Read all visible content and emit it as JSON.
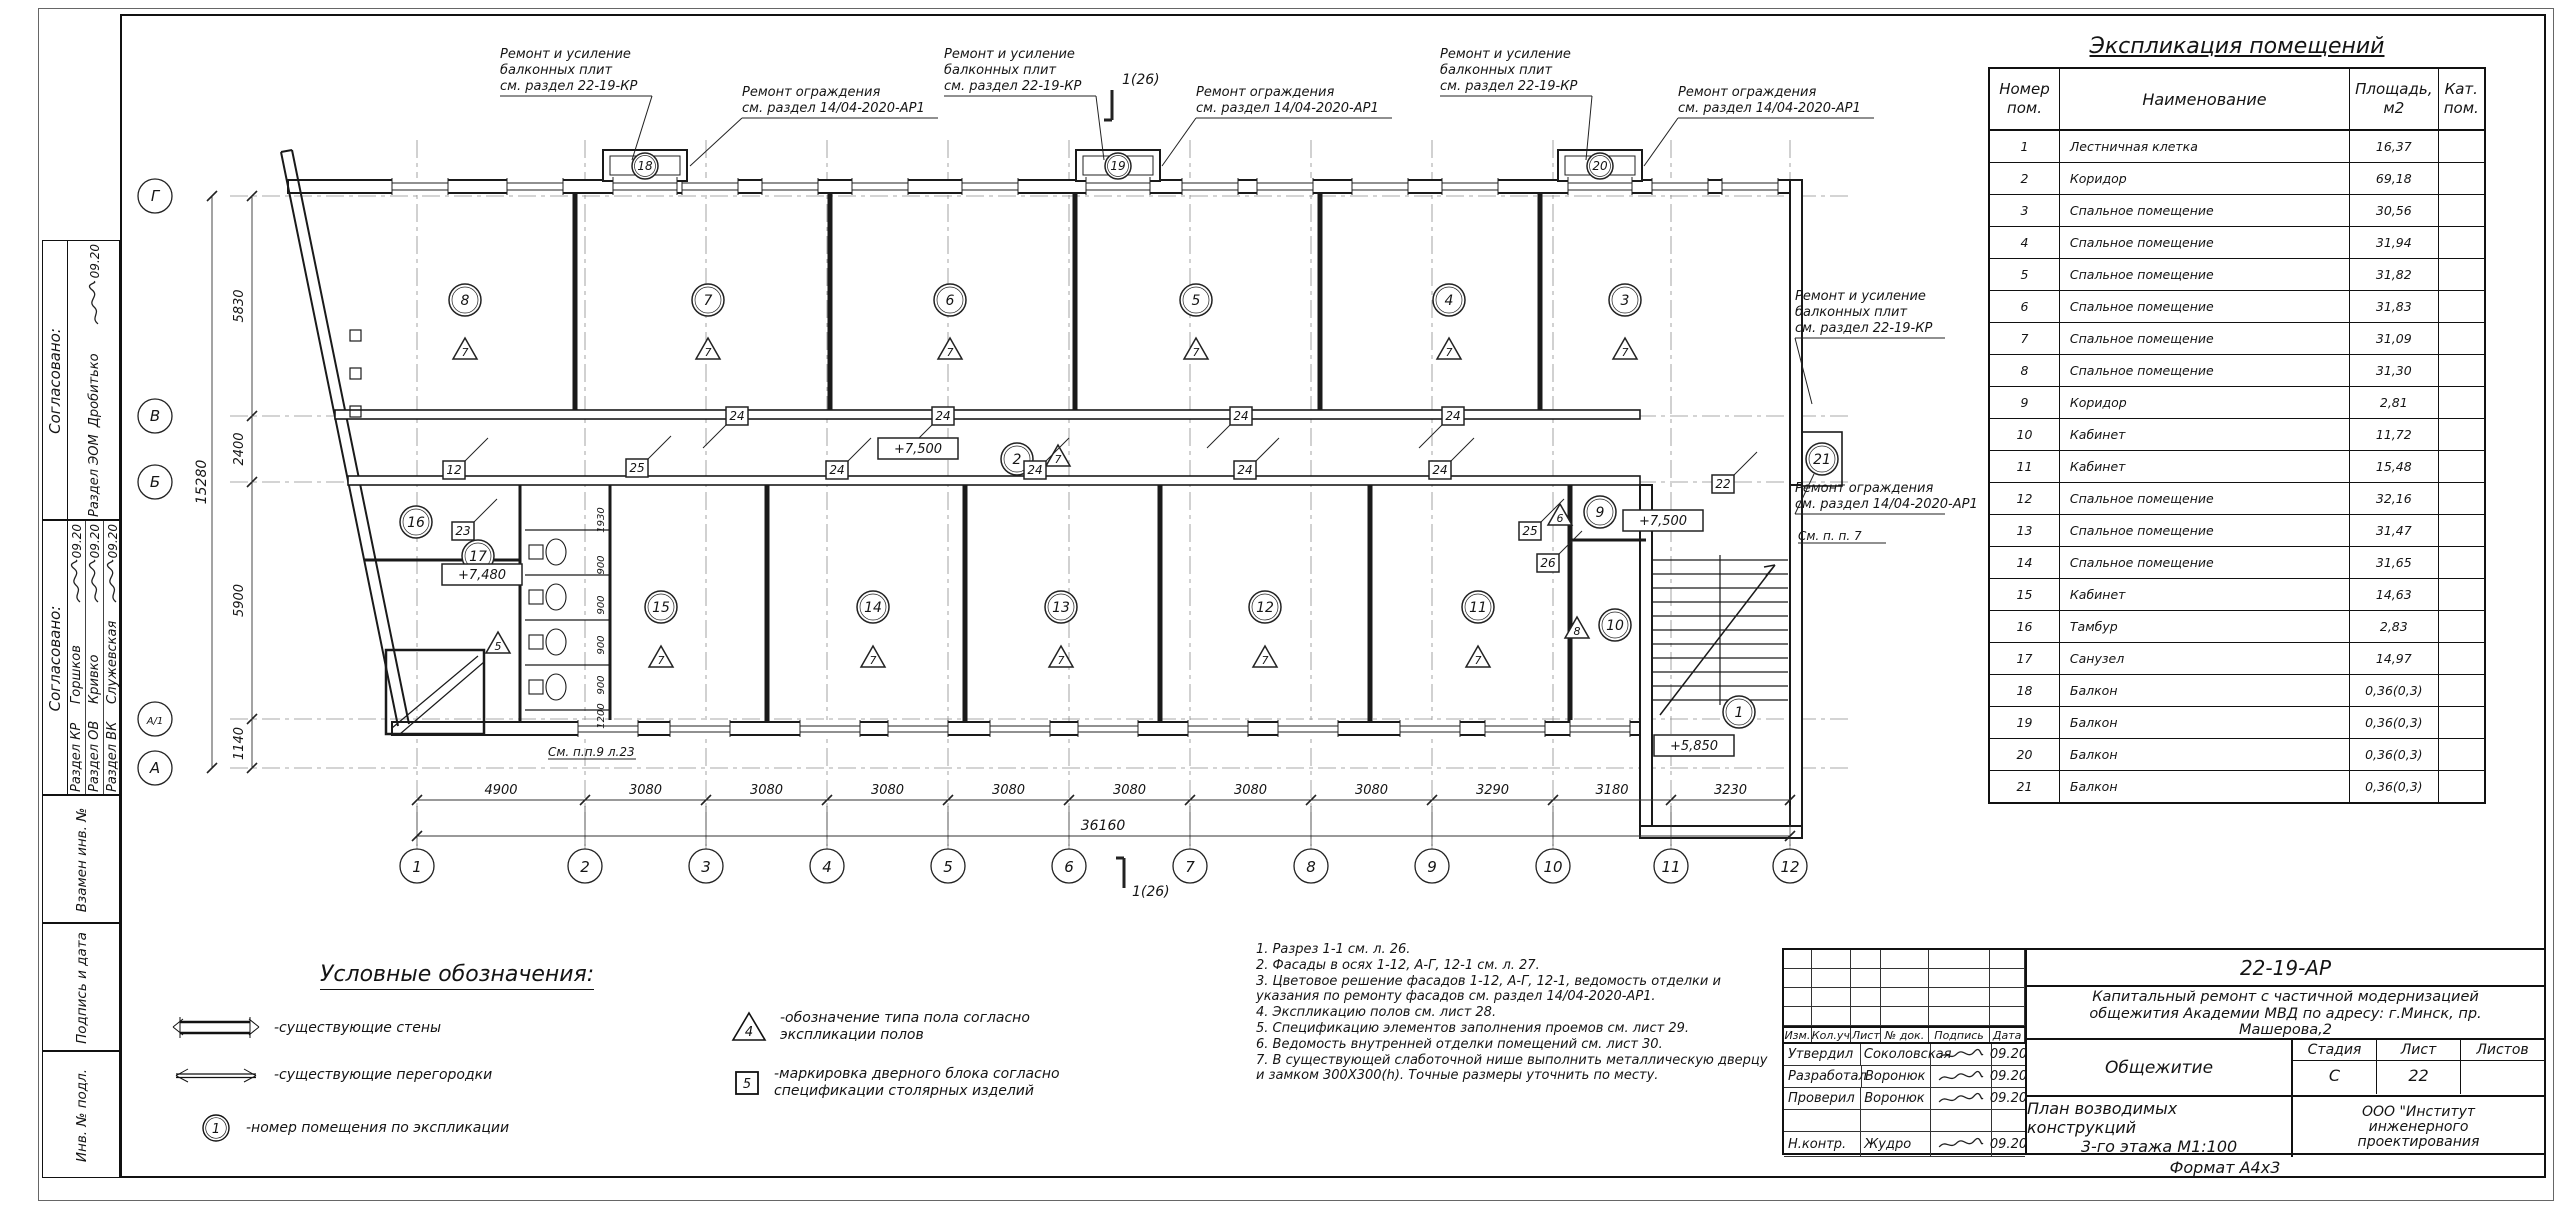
{
  "plan": {
    "axes_x": [
      {
        "l": "1",
        "x": 417
      },
      {
        "l": "2",
        "x": 585
      },
      {
        "l": "3",
        "x": 706
      },
      {
        "l": "4",
        "x": 827
      },
      {
        "l": "5",
        "x": 948
      },
      {
        "l": "6",
        "x": 1069
      },
      {
        "l": "7",
        "x": 1190
      },
      {
        "l": "8",
        "x": 1311
      },
      {
        "l": "9",
        "x": 1432
      },
      {
        "l": "10",
        "x": 1553
      },
      {
        "l": "11",
        "x": 1671
      },
      {
        "l": "12",
        "x": 1790
      }
    ],
    "dims_x": [
      "4900",
      "3080",
      "3080",
      "3080",
      "3080",
      "3080",
      "3080",
      "3080",
      "3290",
      "3180",
      "3230"
    ],
    "total_x": "36160",
    "axes_y": [
      {
        "l": "Г",
        "y": 196
      },
      {
        "l": "В",
        "y": 416
      },
      {
        "l": "Б",
        "y": 482
      },
      {
        "l": "А/1",
        "y": 719
      },
      {
        "l": "А",
        "y": 768
      }
    ],
    "dims_y": [
      "5830",
      "2400",
      "5900",
      "1140"
    ],
    "total_y": "15280",
    "section_mark": "1(26)",
    "rooms": [
      {
        "n": "8",
        "x": 465,
        "y": 300,
        "t": "7",
        "tx": 465,
        "ty": 352
      },
      {
        "n": "7",
        "x": 708,
        "y": 300,
        "t": "7",
        "tx": 708,
        "ty": 352
      },
      {
        "n": "6",
        "x": 950,
        "y": 300,
        "t": "7",
        "tx": 950,
        "ty": 352
      },
      {
        "n": "5",
        "x": 1196,
        "y": 300,
        "t": "7",
        "tx": 1196,
        "ty": 352
      },
      {
        "n": "4",
        "x": 1449,
        "y": 300,
        "t": "7",
        "tx": 1449,
        "ty": 352
      },
      {
        "n": "3",
        "x": 1625,
        "y": 300,
        "t": "7",
        "tx": 1625,
        "ty": 352
      },
      {
        "n": "2",
        "x": 1017,
        "y": 459,
        "t": "7",
        "tx": 1058,
        "ty": 459
      },
      {
        "n": "16",
        "x": 416,
        "y": 522
      },
      {
        "n": "17",
        "x": 478,
        "y": 556,
        "t": "5",
        "tx": 498,
        "ty": 646
      },
      {
        "n": "15",
        "x": 661,
        "y": 607,
        "t": "7",
        "tx": 661,
        "ty": 660
      },
      {
        "n": "14",
        "x": 873,
        "y": 607,
        "t": "7",
        "tx": 873,
        "ty": 660
      },
      {
        "n": "13",
        "x": 1061,
        "y": 607,
        "t": "7",
        "tx": 1061,
        "ty": 660
      },
      {
        "n": "12",
        "x": 1265,
        "y": 607,
        "t": "7",
        "tx": 1265,
        "ty": 660
      },
      {
        "n": "11",
        "x": 1478,
        "y": 607,
        "t": "7",
        "tx": 1478,
        "ty": 660
      },
      {
        "n": "10",
        "x": 1615,
        "y": 625,
        "t": "8",
        "tx": 1577,
        "ty": 631
      },
      {
        "n": "9",
        "x": 1600,
        "y": 512,
        "t": "6",
        "tx": 1560,
        "ty": 518
      },
      {
        "n": "1",
        "x": 1739,
        "y": 712
      },
      {
        "n": "21",
        "x": 1822,
        "y": 459
      }
    ],
    "door_marks": [
      [
        "12",
        454,
        470
      ],
      [
        "25",
        637,
        468
      ],
      [
        "24",
        737,
        416
      ],
      [
        "24",
        943,
        416
      ],
      [
        "24",
        1241,
        416
      ],
      [
        "24",
        1453,
        416
      ],
      [
        "24",
        837,
        470
      ],
      [
        "24",
        1035,
        470
      ],
      [
        "24",
        1245,
        470
      ],
      [
        "24",
        1440,
        470
      ],
      [
        "23",
        463,
        531
      ],
      [
        "25",
        1530,
        531
      ],
      [
        "26",
        1548,
        563
      ],
      [
        "22",
        1723,
        484
      ]
    ],
    "balconies": [
      {
        "n": "18",
        "x": 645
      },
      {
        "n": "19",
        "x": 1118
      },
      {
        "n": "20",
        "x": 1600
      }
    ],
    "elevations": [
      {
        "t": "+7,500",
        "x": 918,
        "y": 449
      },
      {
        "t": "+7,500",
        "x": 1663,
        "y": 521
      },
      {
        "t": "+7,480",
        "x": 482,
        "y": 575
      },
      {
        "t": "+5,850",
        "x": 1694,
        "y": 746
      }
    ],
    "stall_dims": [
      {
        "t": "1930",
        "y": 520
      },
      {
        "t": "900",
        "y": 565
      },
      {
        "t": "900",
        "y": 605
      },
      {
        "t": "900",
        "y": 645
      },
      {
        "t": "900",
        "y": 685
      },
      {
        "t": "1200",
        "y": 716
      }
    ],
    "plan_notes": [
      {
        "t": "См. п.п.9 л.23",
        "x": 548,
        "y": 756
      },
      {
        "t": "См. п. п. 7",
        "x": 1798,
        "y": 540
      }
    ],
    "annotations": [
      {
        "x": 500,
        "y": 58,
        "w": 152,
        "tx": 632,
        "ty": 160,
        "lines": [
          "Ремонт и усиление",
          "балконных плит",
          "см. раздел 22-19-КР"
        ]
      },
      {
        "x": 742,
        "y": 96,
        "w": 196,
        "tx": 690,
        "ty": 166,
        "lines": [
          "Ремонт ограждения",
          "см. раздел 14/04-2020-АР1"
        ]
      },
      {
        "x": 944,
        "y": 58,
        "w": 152,
        "tx": 1104,
        "ty": 160,
        "lines": [
          "Ремонт и усиление",
          "балконных плит",
          "см. раздел 22-19-КР"
        ]
      },
      {
        "x": 1196,
        "y": 96,
        "w": 196,
        "tx": 1162,
        "ty": 166,
        "lines": [
          "Ремонт ограждения",
          "см. раздел 14/04-2020-АР1"
        ]
      },
      {
        "x": 1440,
        "y": 58,
        "w": 152,
        "tx": 1586,
        "ty": 160,
        "lines": [
          "Ремонт и усиление",
          "балконных плит",
          "см. раздел 22-19-КР"
        ]
      },
      {
        "x": 1678,
        "y": 96,
        "w": 196,
        "tx": 1644,
        "ty": 166,
        "lines": [
          "Ремонт ограждения",
          "см. раздел 14/04-2020-АР1"
        ]
      },
      {
        "x": 1795,
        "y": 300,
        "w": 150,
        "tx": 1812,
        "ty": 404,
        "lines": [
          "Ремонт и усиление",
          "балконных плит",
          "см. раздел 22-19-КР"
        ]
      },
      {
        "x": 1795,
        "y": 492,
        "w": 150,
        "tx": 1814,
        "ty": 474,
        "lines": [
          "Ремонт ограждения",
          "см. раздел 14/04-2020-АР1"
        ]
      }
    ]
  },
  "legend": {
    "title": "Условные обозначения:",
    "items": [
      {
        "label": "-существующие стены"
      },
      {
        "label": "-существующие перегородки"
      },
      {
        "symbol_text": "1",
        "label": "-номер помещения по экспликации"
      },
      {
        "symbol_text": "4",
        "label_lines": [
          "-обозначение типа пола согласно",
          "экспликации полов"
        ]
      },
      {
        "symbol_text": "5",
        "label_lines": [
          "-маркировка дверного блока согласно",
          "спецификации столярных изделий"
        ]
      }
    ]
  },
  "notes_lines": [
    "1. Разрез 1-1 см. л. 26.",
    "2. Фасады в осях 1-12, А-Г, 12-1 см. л. 27.",
    "3. Цветовое решение фасадов 1-12, А-Г, 12-1, ведомость отделки и",
    "указания по ремонту фасадов  см. раздел 14/04-2020-АР1.",
    "4. Экспликацию полов см. лист 28.",
    "5. Спецификацию элементов заполнения проемов см. лист 29.",
    "6. Ведомость внутренней отделки помещений см. лист 30.",
    "7. В существующей слаботочной нише выполнить  металлическую дверцу",
    "и замком 300Х300(h). Точные размеры уточнить по месту."
  ],
  "expl_table": {
    "title": "Экспликация помещений",
    "headers": [
      [
        "Номер",
        "пом."
      ],
      [
        "Наименование"
      ],
      [
        "Площадь,",
        "м2"
      ],
      [
        "Кат.",
        "пом."
      ]
    ],
    "rows": [
      [
        "1",
        "Лестничная клетка",
        "16,37"
      ],
      [
        "2",
        "Коридор",
        "69,18"
      ],
      [
        "3",
        "Спальное помещение",
        "30,56"
      ],
      [
        "4",
        "Спальное помещение",
        "31,94"
      ],
      [
        "5",
        "Спальное помещение",
        "31,82"
      ],
      [
        "6",
        "Спальное помещение",
        "31,83"
      ],
      [
        "7",
        "Спальное помещение",
        "31,09"
      ],
      [
        "8",
        "Спальное помещение",
        "31,30"
      ],
      [
        "9",
        "Коридор",
        "2,81"
      ],
      [
        "10",
        "Кабинет",
        "11,72"
      ],
      [
        "11",
        "Кабинет",
        "15,48"
      ],
      [
        "12",
        "Спальное помещение",
        "32,16"
      ],
      [
        "13",
        "Спальное помещение",
        "31,47"
      ],
      [
        "14",
        "Спальное помещение",
        "31,65"
      ],
      [
        "15",
        "Кабинет",
        "14,63"
      ],
      [
        "16",
        "Тамбур",
        "2,83"
      ],
      [
        "17",
        "Санузел",
        "14,97"
      ],
      [
        "18",
        "Балкон",
        "0,36(0,3)"
      ],
      [
        "19",
        "Балкон",
        "0,36(0,3)"
      ],
      [
        "20",
        "Балкон",
        "0,36(0,3)"
      ],
      [
        "21",
        "Балкон",
        "0,36(0,3)"
      ]
    ]
  },
  "left_strip": {
    "agreed_label": "Согласовано:",
    "groups": [
      {
        "rows": [
          {
            "section": "Раздел ЭОМ",
            "name": "Дробитько",
            "date": "09.20"
          }
        ]
      },
      {
        "rows": [
          {
            "section": "Раздел КР",
            "name": "Горшков",
            "date": "09.20"
          },
          {
            "section": "Раздел ОВ",
            "name": "Кривко",
            "date": "09.20"
          },
          {
            "section": "Раздел ВК",
            "name": "Служевская",
            "date": "09.20"
          }
        ]
      }
    ],
    "bottom_cells": [
      "Взамен инв. №",
      "Подпись и дата",
      "Инв. № подл."
    ]
  },
  "title_block": {
    "code": "22-19-АР",
    "description_lines": [
      "Капитальный ремонт с частичной модернизацией",
      "общежития Академии МВД по адресу: г.Минск, пр.",
      "Машерова,2"
    ],
    "object_name": "Общежитие",
    "stage_label": "Стадия",
    "sheet_label": "Лист",
    "sheets_label": "Листов",
    "stage_value": "С",
    "sheet_value": "22",
    "sheets_value": "",
    "sheet_title_lines": [
      "План возводимых конструкций",
      "3-го этажа М1:100"
    ],
    "company_lines": [
      "ООО \"Институт",
      "инженерного",
      "проектирования"
    ],
    "format": "Формат А4х3",
    "rev_header": [
      "Изм.",
      "Кол.уч.",
      "Лист",
      "№ док.",
      "Подпись",
      "Дата"
    ],
    "sign_rows": [
      {
        "role": "Утвердил",
        "name": "Соколовская",
        "date": "09.20"
      },
      {
        "role": "Разработал",
        "name": "Воронюк",
        "date": "09.20"
      },
      {
        "role": "Проверил",
        "name": "Воронюк",
        "date": "09.20"
      },
      {
        "role": "",
        "name": "",
        "date": ""
      },
      {
        "role": "Н.контр.",
        "name": "Жудро",
        "date": "09.20"
      }
    ]
  }
}
